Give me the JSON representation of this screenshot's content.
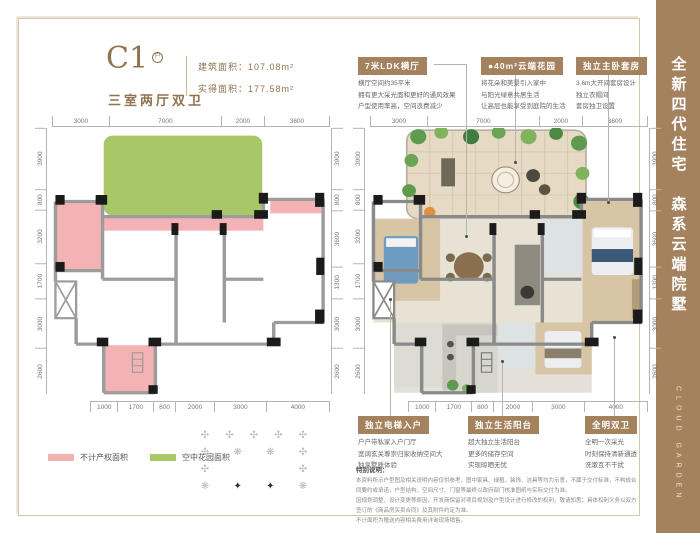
{
  "colors": {
    "accent": "#a5825e",
    "brand_text": "#8f734e",
    "pink_area": "#f3b2b4",
    "green_area": "#a8c868",
    "frame": "#d2c7ae"
  },
  "header": {
    "unit_code": "C1",
    "unit_badge": "户",
    "unit_subtitle": "三室两厅双卫",
    "area_lines": [
      "建筑面积：107.08m²",
      "实得面积：177.58m²"
    ]
  },
  "sidebar": {
    "title_cn": "全新四代住宅　森系云端院墅",
    "title_en": "CLOUD GARDEN"
  },
  "callouts_top": [
    {
      "title": "7米LDK横厅",
      "lines": [
        "横厅空间约35平米",
        "拥有更大采光面和更好的通风效果",
        "户型使用率高，空间浪费减少"
      ]
    },
    {
      "title": "●40m²云端花园",
      "lines": [
        "将花朵和美景引入家中",
        "与阳光绿意共居生活",
        "让高层也能享受到庭院的生活"
      ]
    },
    {
      "title": "独立主卧套房",
      "lines": [
        "3.6m大开间套房设计",
        "独立衣帽间",
        "套房独卫设置"
      ]
    }
  ],
  "callouts_bottom": [
    {
      "title": "独立电梯入户",
      "lines": [
        "户户带私家入户门厅",
        "宽阔玄关尊崇归家收纳空间大",
        "独享墅质体验"
      ]
    },
    {
      "title": "独立生活阳台",
      "lines": [
        "超大独立生活阳台",
        "更多的储存空间",
        "实现晾晒无忧"
      ]
    },
    {
      "title": "全明双卫",
      "lines": [
        "全明一次采光",
        "时刻保持清新通透",
        "洗漱互不干扰"
      ]
    }
  ],
  "legend": [
    {
      "label": "不计产权面积",
      "color": "#f3b2b4"
    },
    {
      "label": "空中花园面积",
      "color": "#a8c868"
    }
  ],
  "dims": {
    "top": [
      "3000",
      "7000",
      "2000",
      "3600"
    ],
    "left": [
      "3900",
      "800",
      "3200",
      "1700",
      "3000",
      "2600"
    ],
    "right": [
      "3900",
      "800",
      "3600",
      "1300",
      "3000",
      "2600"
    ],
    "bottom": [
      "1000",
      "1700",
      "800",
      "2000",
      "3000",
      "4000"
    ]
  },
  "motif": {
    "rows": [
      [
        {
          "t": "✣"
        },
        {
          "t": "✣"
        },
        {
          "t": "✣"
        },
        {
          "t": "✣"
        },
        {
          "t": "✣"
        }
      ],
      [
        {
          "t": "✣"
        },
        {
          "t": "❋"
        },
        {
          "t": "❋"
        },
        {
          "t": "✣"
        }
      ],
      [
        {
          "t": "✣"
        },
        {
          "t": "✣"
        }
      ],
      [
        {
          "t": "❋"
        },
        {
          "t": "✦",
          "c": "dark"
        },
        {
          "t": "✦",
          "c": "dark"
        },
        {
          "t": "❋"
        }
      ]
    ]
  },
  "disclaimer": {
    "title": "特别说明：",
    "lines": [
      "本资料所示户型图及相关说明内容仅供参考，图中家具、绿植、装饰、洁具等均为示意，不属于交付标准，不构成合同要约或承诺，户型结构、空间尺寸、门窗等最终以政府部门核准图纸与实际交付为准。",
      "因规划调整、设计变更等原因，开发商保留对项目规划及户型设计进行修改的权利，敬请知悉；具体权利义务以双方签订的《商品房买卖合同》及其附件约定为准。",
      "不计面积为赠送内容相关费用详询现场销售。"
    ]
  }
}
